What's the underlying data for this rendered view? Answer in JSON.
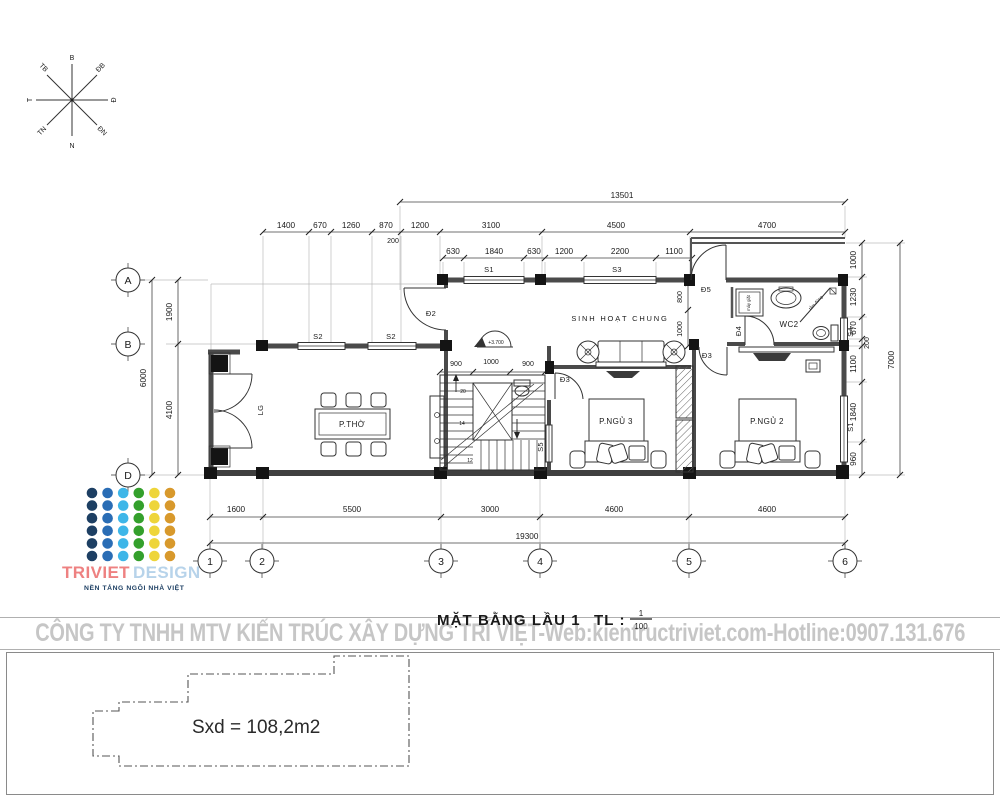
{
  "compass": {
    "n": "B",
    "ne": "ĐB",
    "e": "Đ",
    "se": "ĐN",
    "s": "N",
    "sw": "TN",
    "w": "T",
    "nw": "TB"
  },
  "grid": {
    "row_a": "A",
    "row_b": "B",
    "row_d": "D",
    "col_1": "1",
    "col_2": "2",
    "col_3": "3",
    "col_4": "4",
    "col_5": "5",
    "col_6": "6"
  },
  "dims": {
    "top_total": "13501",
    "top_row": [
      "1400",
      "670",
      "1260",
      "870",
      "1200",
      "3100",
      "4500",
      "4700"
    ],
    "top_offset": "200",
    "front_row": [
      "630",
      "1840",
      "630",
      "1200",
      "2200",
      "1100"
    ],
    "left_segments": [
      "1900",
      "4100"
    ],
    "left_total": "6000",
    "right_segments": [
      "1000",
      "1230",
      "670",
      "200",
      "1100",
      "1840",
      "960"
    ],
    "right_total": "7000",
    "bottom_segments": [
      "1600",
      "5500",
      "3000",
      "4600",
      "4600"
    ],
    "bottom_total": "19300",
    "stair_row": [
      "900",
      "1000",
      "900"
    ],
    "inner_right": [
      "800",
      "1000"
    ]
  },
  "rooms": {
    "worship": "P.THỜ",
    "living": "SINH HOẠT CHUNG",
    "wc": "WC2",
    "bedroom3": "P.NGỦ 3",
    "bedroom2": "P.NGỦ 2"
  },
  "openings": {
    "d2": "Đ2",
    "d3": "Đ3",
    "d4": "Đ4",
    "d5": "Đ5",
    "s1": "S1",
    "s2": "S2",
    "s3": "S3",
    "s4": "S4",
    "s5": "S5",
    "lg": "LG"
  },
  "stairs": {
    "n20": "20",
    "n14": "14",
    "n12": "12"
  },
  "annotations": {
    "level": "+3.700",
    "washer": "máy giặt",
    "shower": "tắm đứng"
  },
  "title": {
    "main": "MẶT BẰNG LẦU 1",
    "scale_label": "TL :",
    "scale_num": "1",
    "scale_den": "100"
  },
  "watermark": "CÔNG TY TNHH MTV KIẾN TRÚC XÂY DỰNG TRÍ VIỆT-Web:kientructriviet.com-Hotline:0907.131.676",
  "logo": {
    "brand_primary": "TRIVIET",
    "brand_secondary": "DESIGN",
    "tagline": "NỀN TẢNG NGÔI NHÀ VIỆT",
    "dot_colors": [
      "#1d3f63",
      "#2a6db5",
      "#3eb6e8",
      "#34a02c",
      "#eed53a",
      "#d8992c"
    ],
    "brand_primary_color": "#ee8181",
    "brand_secondary_color": "#b7d3ea",
    "tagline_color": "#1d3f63"
  },
  "footer": {
    "area_note": "Sxd = 108,2m2"
  }
}
